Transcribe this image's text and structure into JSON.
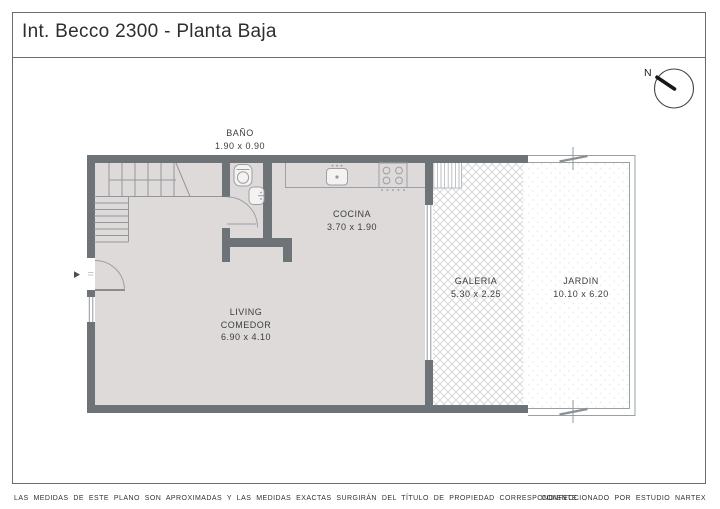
{
  "page": {
    "title": "Int. Becco 2300 - Planta Baja",
    "compass": {
      "label": "N"
    },
    "footer": {
      "left": "LAS MEDIDAS DE ESTE PLANO SON APROXIMADAS Y LAS MEDIDAS EXACTAS SURGIRÁN DEL TÍTULO DE PROPIEDAD CORRESPONDIENTE.",
      "right": "CONFECCIONADO POR ESTUDIO NARTEX"
    }
  },
  "rooms": {
    "bano": {
      "name": "BAÑO",
      "dims": "1.90 x 0.90"
    },
    "cocina": {
      "name": "COCINA",
      "dims": "3.70 x 1.90"
    },
    "living": {
      "line1": "LIVING",
      "line2": "COMEDOR",
      "dims": "6.90 x 4.10"
    },
    "galeria": {
      "name": "GALERIA",
      "dims": "5.30 x 2.25"
    },
    "jardin": {
      "name": "JARDIN",
      "dims": "10.10 x 6.20"
    }
  },
  "colors": {
    "wall": "#6e7377",
    "floor": "#dedad9",
    "line": "#93989c",
    "thin": "#9aa0a4",
    "lattice": "#d8d8d8",
    "stipple": "#e2e2e2",
    "hatch": "#b6babd",
    "border": "#6a6c6e",
    "ink": "#2c2e30",
    "label": "#3a3e41"
  }
}
